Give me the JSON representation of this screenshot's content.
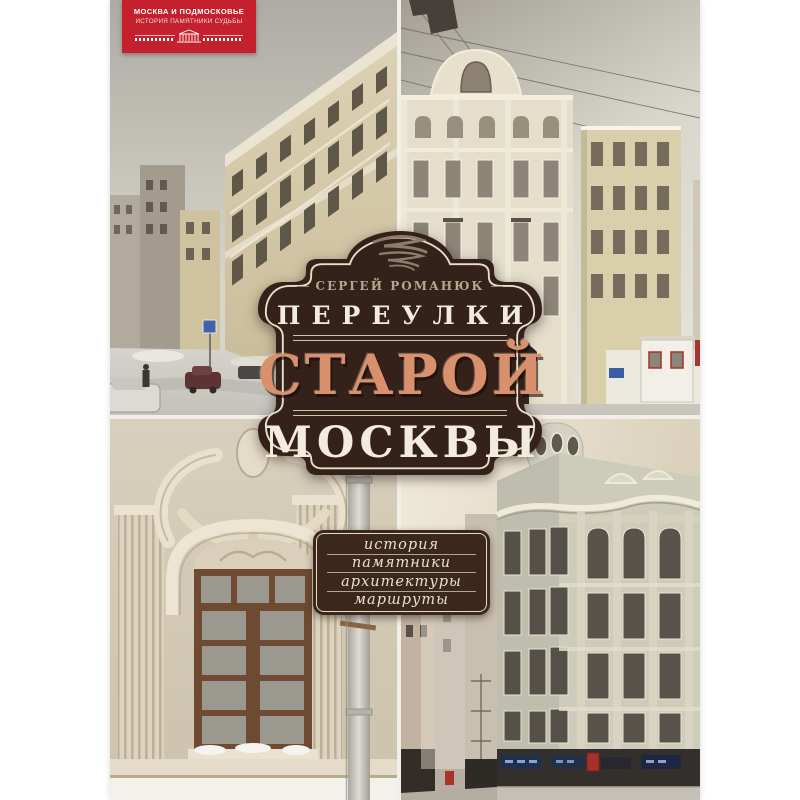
{
  "cover": {
    "kind": "book-cover",
    "background": "#f2efe8"
  },
  "series_badge": {
    "line1": "МОСКВА И ПОДМОСКОВЬЕ",
    "line2": "ИСТОРИЯ ПАМЯТНИКИ СУДЬБЫ",
    "background": "#c5202e",
    "icon": "classical-building-icon"
  },
  "title_badge": {
    "author": "СЕРГЕЙ РОМАНЮК",
    "title_line1": "ПЕРЕУЛКИ",
    "title_line2": "СТАРОЙ",
    "title_line3": "МОСКВЫ",
    "background": "#34211a",
    "border_color": "#e8dfca",
    "accent_color": "#d8906d",
    "text_color": "#f3ecdc",
    "ornament": "calligraphic-flourish"
  },
  "topics_badge": {
    "items": [
      "история",
      "памятники",
      "архитектуры",
      "маршруты"
    ],
    "background": "#3b271c",
    "text_color": "#eae1cb"
  },
  "photos": [
    {
      "position": "top-left",
      "subject": "winter street with classical yellow buildings, parked cars and snow"
    },
    {
      "position": "top-right",
      "subject": "cream mansion facade with curved gable, awning and overhead wires"
    },
    {
      "position": "bottom-left",
      "subject": "baroque stucco window surround with brown wooden window and drainpipe"
    },
    {
      "position": "bottom-right",
      "subject": "art nouveau corner building with turret above narrow street shops"
    }
  ]
}
